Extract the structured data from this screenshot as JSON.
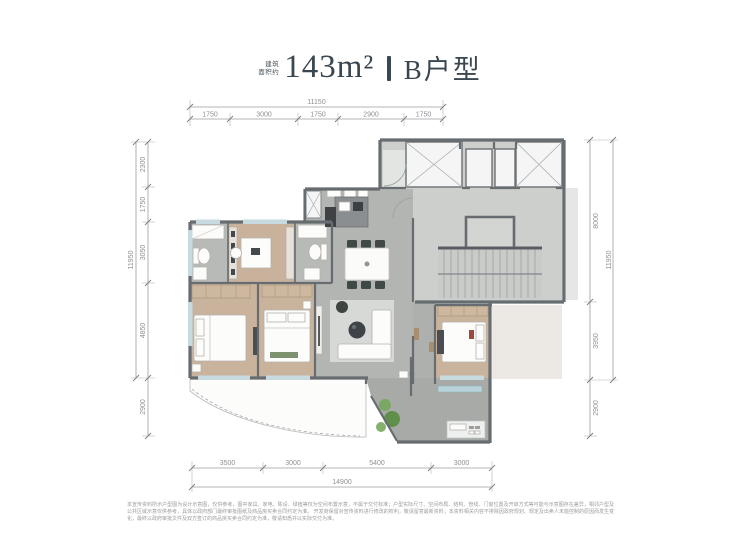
{
  "title": {
    "prefix_line1": "建筑",
    "prefix_line2": "面积约",
    "area": "143m²",
    "unit_type": "B户型"
  },
  "dimensions": {
    "top": {
      "total": "11150",
      "segments": [
        "1750",
        "3000",
        "1750",
        "2900",
        "1750"
      ]
    },
    "bottom": {
      "total": "14900",
      "segments": [
        "3500",
        "3000",
        "5400",
        "3000"
      ]
    },
    "left": {
      "total": "11950",
      "segments": [
        "2300",
        "1750",
        "3050",
        "4850"
      ],
      "lower": "2900"
    },
    "right": {
      "total": "11950",
      "segments": [
        "8000",
        "3950"
      ],
      "lower": "2900"
    }
  },
  "disclaimer": {
    "line1": "本宣传资料所示户型图为设计示意图，仅供参考，图中家具、家电、陈设、绿植等仅为空间布置示意，不属于交付标准；户型实际尺寸、空间布局、结构、管线、门窗位置及开启方式等可能与示意图存在差异，相邻户型及公共区域示意仅供参考，具体以政府部门最终审批图纸及商品房买卖合同约定为准。",
    "line2": "开发商保留对宣传资料进行修改的权利，敬请留意最新资料；本资料相关内容不排除因政府规划、规定及出卖人未能控制的原因而发生变化，最终以政府审批文件及双方签订的商品房买卖合同约定为准，敬请知悉并以实际交付为准。"
  },
  "colors": {
    "title": "#3b4750",
    "wall": "#676c70",
    "dimension_text": "#8d9092",
    "wood_floor": "#cab39c",
    "tile_floor": "#b2b5b2",
    "core_floor": "#cdcfcc"
  }
}
